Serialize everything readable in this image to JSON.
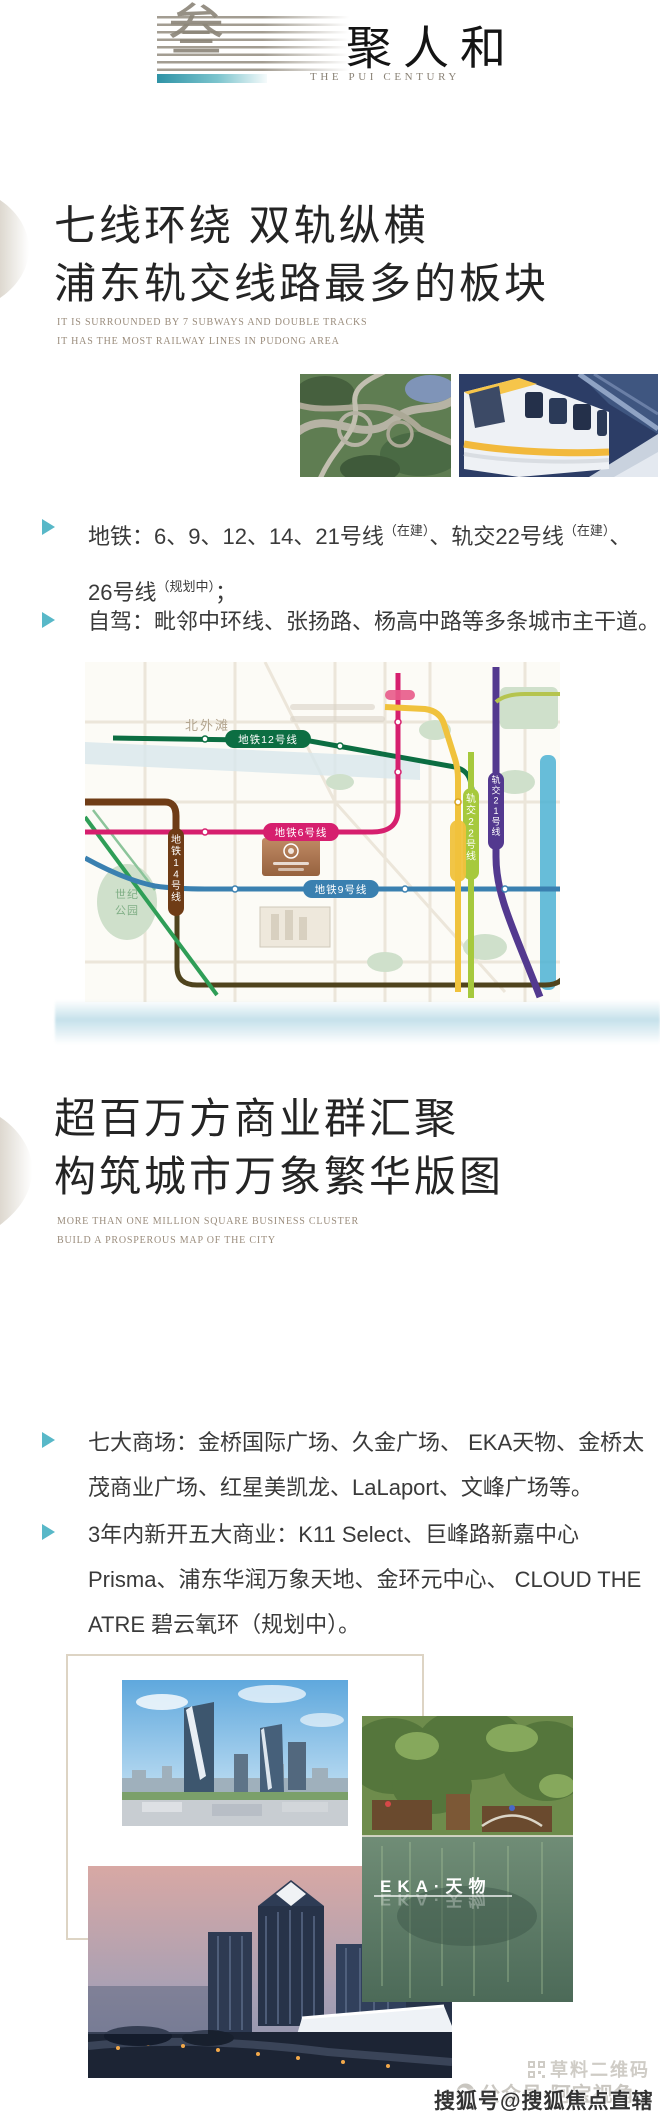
{
  "header": {
    "logo_glyph": "叁",
    "title": "聚人和",
    "subtitle_en": "THE PUI CENTURY"
  },
  "section_transport": {
    "title_line1": "七线环绕 双轨纵横",
    "title_line2": "浦东轨交线路最多的板块",
    "subtitle_en_line1": "IT IS SURROUNDED BY 7 SUBWAYS AND DOUBLE TRACKS",
    "subtitle_en_line2": "IT HAS THE MOST RAILWAY LINES IN PUDONG AREA",
    "bullet_metro": {
      "s1": "地铁：6、9、12、14、21号线",
      "sup1": "（在建）",
      "s2": "、轨交22号线",
      "sup2": "（在建）",
      "s3": "、",
      "s4": "26号线",
      "sup3": "（规划中）",
      "s5": "；"
    },
    "bullet_drive": "自驾：毗邻中环线、张扬路、杨高中路等多条城市主干道。"
  },
  "map": {
    "area_label": "北外滩",
    "park_label_line1": "世纪",
    "park_label_line2": "公园",
    "line12": "地铁12号线",
    "line6": "地铁6号线",
    "line9": "地铁9号线",
    "line14": "地铁14号线",
    "line22": "轨交22号线",
    "line21": "轨交21号线"
  },
  "section_business": {
    "title_line1": "超百万方商业群汇聚",
    "title_line2": "构筑城市万象繁华版图",
    "subtitle_en_line1": "MORE THAN ONE MILLION SQUARE BUSINESS CLUSTER",
    "subtitle_en_line2": "BUILD A PROSPEROUS MAP OF THE CITY",
    "bullet_malls": "七大商场：金桥国际广场、久金广场、 EKA天物、金桥太茂商业广场、红星美凯龙、LaLaport、文峰广场等。",
    "bullet_new": "3年内新开五大商业：K11 Select、巨峰路新嘉中心Prisma、浦东华润万象天地、金环元中心、 CLOUD THE ATRE 碧云氧环（规划中）。",
    "collage_caption": "EKA·天物"
  },
  "watermark": {
    "qr": "草料二维码",
    "wechat": "公众号·阿宝视角",
    "sohu": "搜狐号@搜狐焦点直辖站"
  },
  "colors": {
    "accent_teal": "#58b8c8",
    "line6": "#d61f6e",
    "line9": "#3a80b0",
    "line12": "#0c6e42",
    "line14": "#6f3c16",
    "line21": "#53398f",
    "line22": "#a6c93d",
    "line_yellow": "#f0c23c",
    "river_blue": "#4cb2d3",
    "header_teal": "#2f93a6"
  }
}
